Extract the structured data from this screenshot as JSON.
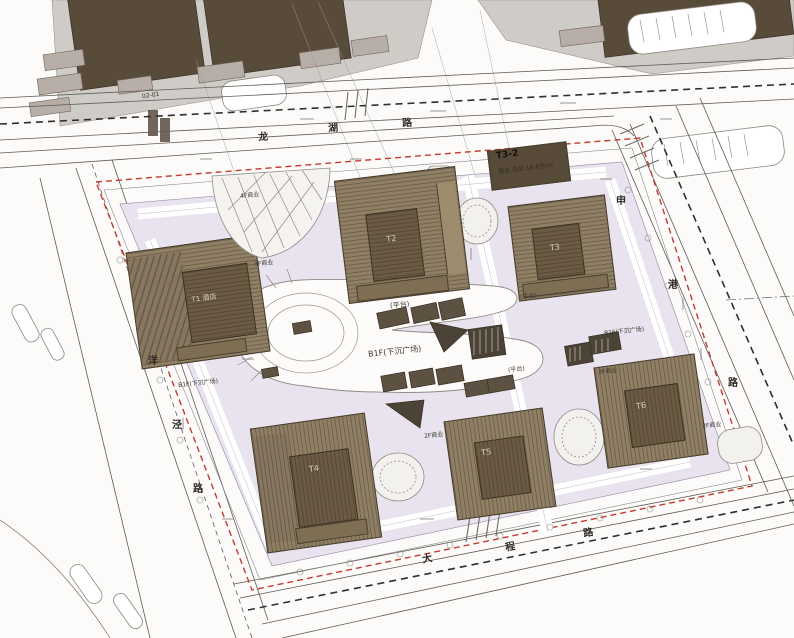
{
  "colors": {
    "property_line_red": "#c23b2e",
    "podium_tint": "#e8e3ee",
    "tower_brown": "#8f7f64",
    "tower_core_brown": "#6b5b44",
    "existing_building_brown": "#594b3a",
    "city_block_gray": "#cfcbc7",
    "road_line_gray": "#5f5b56"
  },
  "roads": {
    "top": {
      "chars": [
        {
          "ch": "龙"
        },
        {
          "ch": "湖"
        },
        {
          "ch": "路"
        }
      ]
    },
    "left": {
      "chars": [
        {
          "ch": "洋"
        },
        {
          "ch": "泾"
        },
        {
          "ch": "路"
        }
      ]
    },
    "bottom": {
      "chars": [
        {
          "ch": "大"
        },
        {
          "ch": "程"
        },
        {
          "ch": "路"
        }
      ]
    },
    "right": {
      "chars": [
        {
          "ch": "申"
        },
        {
          "ch": "港"
        },
        {
          "ch": "路"
        }
      ]
    }
  },
  "buildings": [
    {
      "id": "t1",
      "label": "T1 酒店"
    },
    {
      "id": "t2",
      "label": "T2"
    },
    {
      "id": "t3",
      "label": "T3"
    },
    {
      "id": "t4",
      "label": "T4"
    },
    {
      "id": "t5",
      "label": "T5"
    },
    {
      "id": "t6",
      "label": "T6"
    }
  ],
  "plots": {
    "t32": {
      "label": "T3-2",
      "desc": "商业 办公 18.6万m²"
    }
  },
  "annotations": [
    {
      "text": "B1F(下沉广场)"
    },
    {
      "text": "B1F(下沉广场)"
    },
    {
      "text": "B1F(下沉广场)"
    },
    {
      "text": "(平台)"
    },
    {
      "text": "(平台)"
    },
    {
      "text": "(平台)"
    },
    {
      "text": "4F商业"
    },
    {
      "text": "3F商业"
    },
    {
      "text": "3F商业"
    },
    {
      "text": "2F商业"
    },
    {
      "text": "2F商业"
    },
    {
      "text": "02-01"
    }
  ]
}
